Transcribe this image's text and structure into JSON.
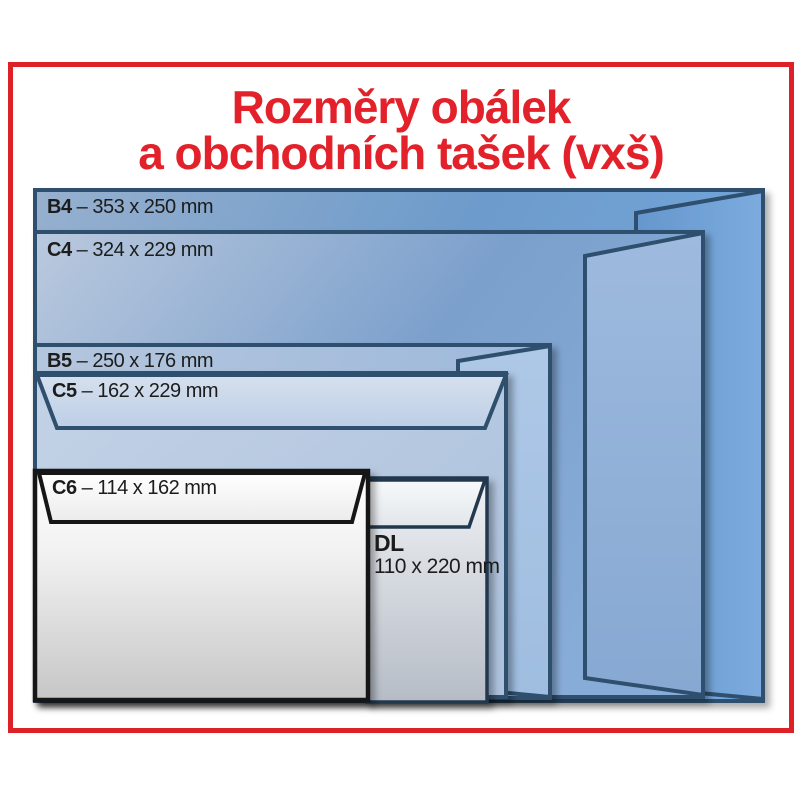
{
  "title": {
    "line1": "Rozměry obálek",
    "line2": "a obchodních tašek (vxš)"
  },
  "envelopes": [
    {
      "code": "B4",
      "dims": "– 353 x 250 mm"
    },
    {
      "code": "C4",
      "dims": "– 324 x 229 mm"
    },
    {
      "code": "B5",
      "dims": "– 250 x 176 mm"
    },
    {
      "code": "C5",
      "dims": "– 162 x 229 mm"
    },
    {
      "code": "C6",
      "dims": "– 114 x 162 mm"
    },
    {
      "code": "DL",
      "dims": "110 x 220 mm"
    }
  ],
  "colors": {
    "accent_red": "#de2027",
    "outline_blue": "#2f4f6e",
    "outline_black": "#161616",
    "outline_navy": "#24384e"
  }
}
